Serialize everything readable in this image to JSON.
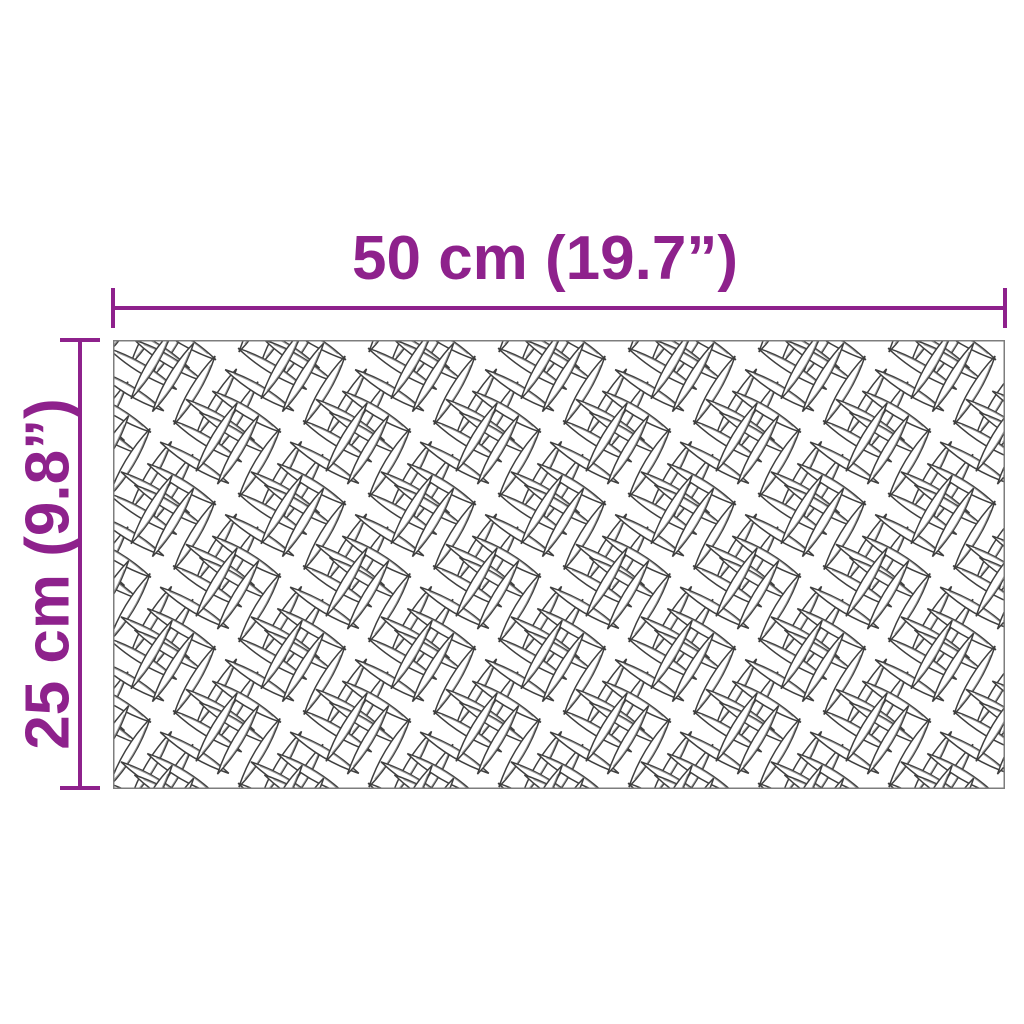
{
  "diagram": {
    "subject": "checker-plate-sheet",
    "dimensions": {
      "width": {
        "label": "50 cm (19.7”)",
        "cm": 50,
        "inches": 19.7
      },
      "height": {
        "label": "25 cm (9.8”)",
        "cm": 25,
        "inches": 9.8
      }
    }
  },
  "colors": {
    "background": "#ffffff",
    "dimension": "#8e218c",
    "plate-border": "#7d7d7d",
    "lens-outline": "#3f3f3f",
    "lens-inner": "#9a9a9a"
  }
}
